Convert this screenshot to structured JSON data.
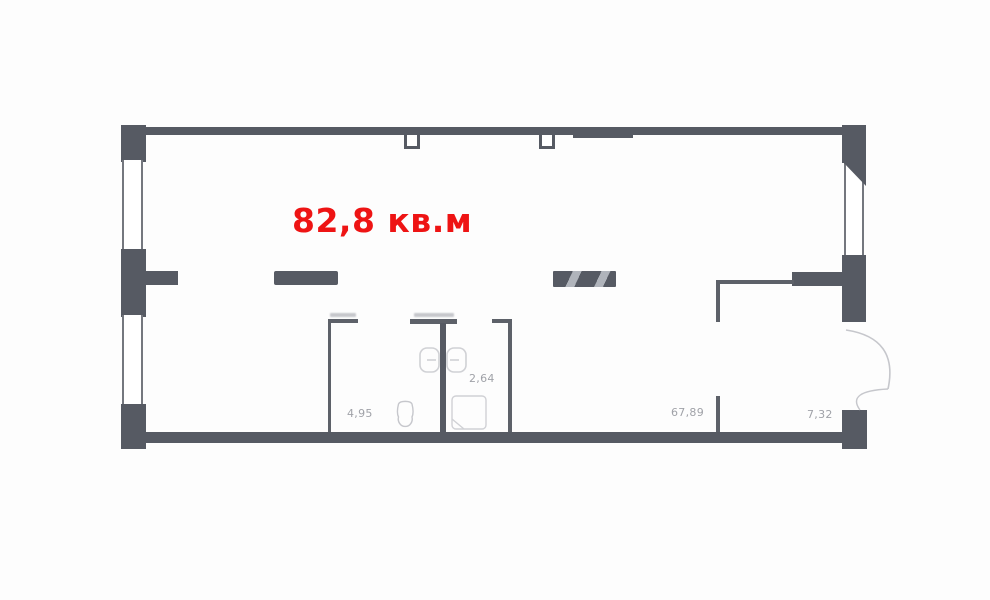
{
  "plan": {
    "total_area_label": "82,8 кв.м",
    "rooms": [
      {
        "name": "main-room",
        "area_label": "67,89"
      },
      {
        "name": "bathroom",
        "area_label": "4,95"
      },
      {
        "name": "wc",
        "area_label": "2,64"
      },
      {
        "name": "hallway",
        "area_label": "7,32"
      }
    ],
    "fixtures": [
      "toilet-icon",
      "double-washbasin-icon",
      "shower-tray-icon",
      "door-swing-arc",
      "vent-shaft-icon"
    ],
    "colors": {
      "wall": "#565a63",
      "accent_area_text": "#ee1414",
      "room_label_text": "#a0a2a8",
      "fixture_line": "#c6c7cc",
      "background": "#fdfdfd"
    }
  }
}
